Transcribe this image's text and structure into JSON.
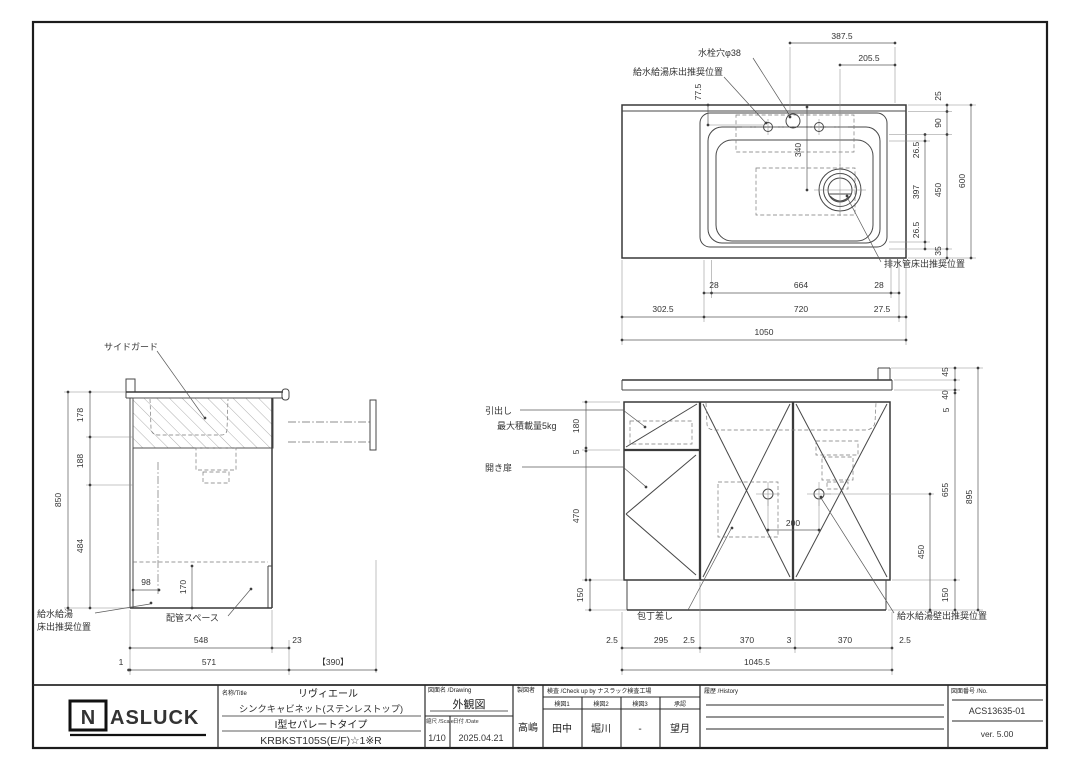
{
  "page": {
    "background": "#ffffff",
    "line_color": "#3f3f3f"
  },
  "plan_view": {
    "labels": {
      "faucet_hole": "水栓穴φ38",
      "supply_floor": "給水給湯床出推奨位置",
      "drain_floor": "排水管床出推奨位置"
    },
    "dims": {
      "top_387": "387.5",
      "top_205": "205.5",
      "left_77": "77.5",
      "center_340": "340",
      "right_25": "25",
      "right_90": "90",
      "right_26a": "26.5",
      "right_397": "397",
      "right_26b": "26.5",
      "right_35": "35",
      "right_450": "450",
      "right_600": "600",
      "bottom_28a": "28",
      "bottom_664": "664",
      "bottom_28b": "28",
      "bottom_302": "302.5",
      "bottom_720": "720",
      "bottom_27": "27.5",
      "bottom_1050": "1050"
    }
  },
  "side_view": {
    "labels": {
      "side_guard": "サイドガード",
      "supply_floor_line1": "給水給湯",
      "supply_floor_line2": "床出推奨位置",
      "pipe_space": "配管スペース"
    },
    "dims": {
      "v_178": "178",
      "v_188": "188",
      "v_484": "484",
      "v_850": "850",
      "d_98": "98",
      "d_170": "170",
      "b_548": "548",
      "b_23": "23",
      "b_1": "1",
      "b_571": "571",
      "b_390": "【390】"
    }
  },
  "front_view": {
    "labels": {
      "drawer": "引出し",
      "drawer_load": "最大積載量5kg",
      "hinged_door": "開き扉",
      "knife_holder": "包丁差し",
      "supply_wall": "給水給湯壁出推奨位置"
    },
    "dims": {
      "l_180": "180",
      "l_5": "5",
      "l_470": "470",
      "l_150": "150",
      "r_45": "45",
      "r_40": "40",
      "r_5": "5",
      "r_655": "655",
      "r_150": "150",
      "r_895": "895",
      "r_450": "450",
      "c_200": "200",
      "b_25a": "2.5",
      "b_295": "295",
      "b_25b": "2.5",
      "b_370a": "370",
      "b_3": "3",
      "b_370b": "370",
      "b_25c": "2.5",
      "b_total": "1045.5"
    }
  },
  "title_block": {
    "logo_n": "N",
    "logo_text": "ASLUCK",
    "name_label": "名称/Title",
    "name_value": "リヴィエール",
    "name_line2": "シンクキャビネット(ステンレストップ)",
    "name_line3": "I型セパレートタイプ",
    "name_line4": "KRBKST105S(E/F)☆1※R",
    "drawing_label": "図面名 /Drawing",
    "drawing_value": "外観図",
    "scale_label": "縮尺 /Scale",
    "scale_value": "1/10",
    "date_label": "日付 /Date",
    "date_value": "2025.04.21",
    "drafter_label": "製図者",
    "drafter_value": "高嶋",
    "check_label": "検査 /Check up by ナスラック検査工場",
    "check_cols": [
      "検図1",
      "検図2",
      "検図3",
      "承認"
    ],
    "check_vals": [
      "田中",
      "堀川",
      "-",
      "望月"
    ],
    "history_label": "履歴 /History",
    "no_label": "図面番号 /No.",
    "no_value": "ACS13635-01",
    "version": "ver. 5.00"
  }
}
